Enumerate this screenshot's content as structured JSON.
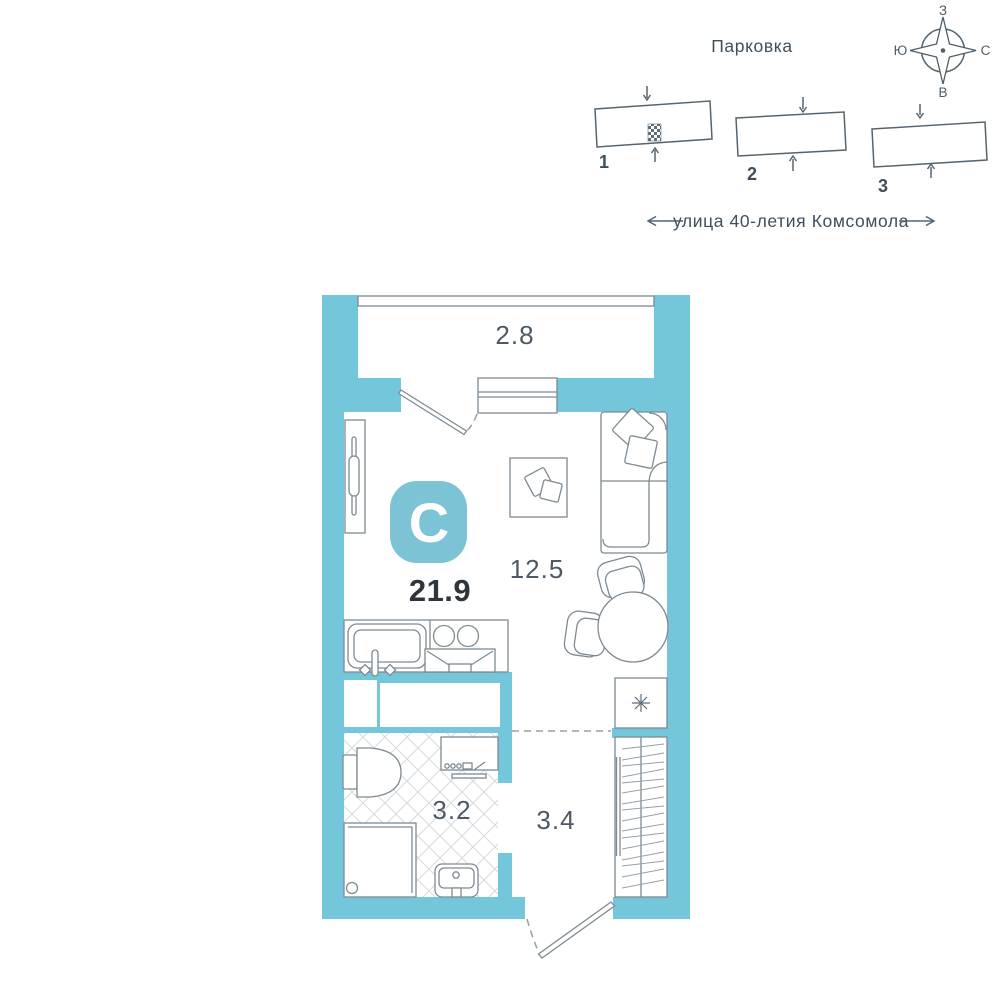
{
  "site_plan": {
    "title": "Парковка",
    "street": "улица 40-летия Комсомола",
    "buildings": [
      {
        "number": "1"
      },
      {
        "number": "2"
      },
      {
        "number": "3"
      }
    ],
    "compass": {
      "top": "З",
      "right": "С",
      "bottom": "В",
      "left": "Ю"
    }
  },
  "floor_plan": {
    "logo_letter": "С",
    "total_area": "21.9",
    "balcony_area": "2.8",
    "living_area": "12.5",
    "bathroom_area": "3.2",
    "hallway_area": "3.4",
    "fridge_icon": "snowflake-icon"
  },
  "colors": {
    "wall": "#74c7da",
    "logo_badge": "#7cc3d5",
    "furniture_outline": "#7d8a95",
    "site_outline": "#55646f",
    "area_text": "#4d5965",
    "total_text": "#2e353b",
    "tile_line": "#d5dade"
  }
}
